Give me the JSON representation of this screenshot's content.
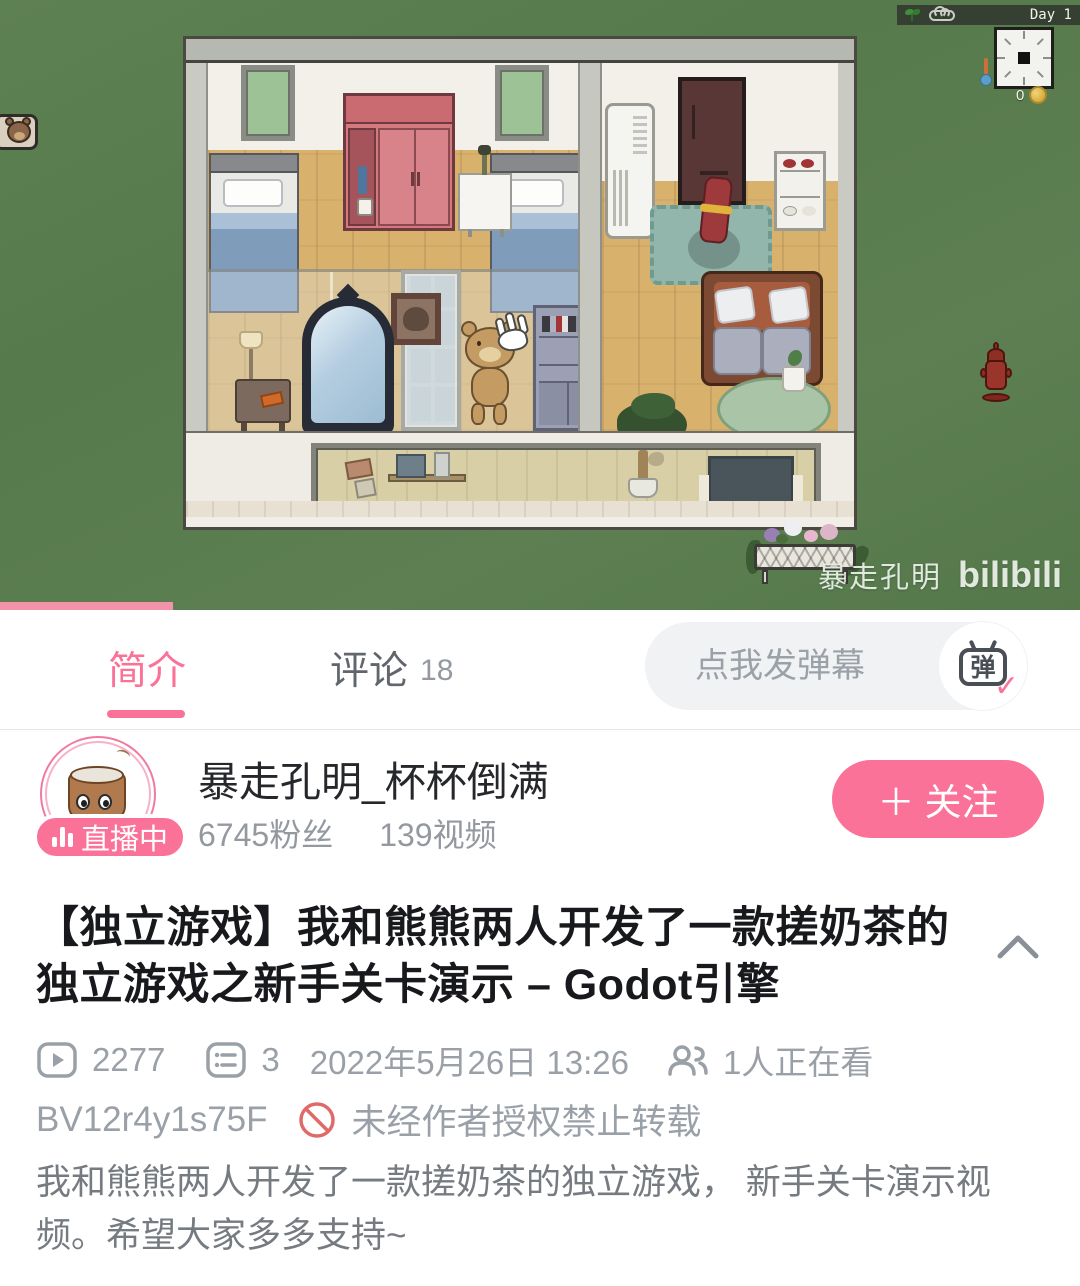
{
  "colors": {
    "brand_pink": "#fb7299",
    "progress_pink": "#f293ab",
    "text_dark": "#18191c",
    "text_gray": "#9aa0a7",
    "desc_gray": "#767b81",
    "grass_green": "#5a7d50",
    "prohibit_red": "#e06a6a"
  },
  "video": {
    "hud": {
      "day_label": "Day 1",
      "coin_count": "0",
      "sprout_icon": "sprout-icon",
      "cloud_icon": "cloud-icon",
      "clock_icon": "analog-clock",
      "thermometer_icon": "thermometer-icon",
      "coin_icon": "gold-coin-icon"
    },
    "watermark": {
      "uploader": "暴走孔明",
      "logo": "bilibili"
    },
    "progress_percent": 16
  },
  "tabs": {
    "intro": "简介",
    "comments": "评论",
    "comments_count": "18"
  },
  "danmaku": {
    "placeholder": "点我发弹幕",
    "toggle_char": "弹",
    "toggle_check": "✓"
  },
  "uploader": {
    "name": "暴走孔明_杯杯倒满",
    "fans": "6745粉丝",
    "videos": "139视频",
    "live_badge": "直播中",
    "follow_plus": "＋",
    "follow_label": "关注"
  },
  "video_info": {
    "title": "【独立游戏】我和熊熊两人开发了一款搓奶茶的独立游戏之新手关卡演示 – Godot引擎",
    "play_count": "2277",
    "comment_count": "3",
    "publish_date": "2022年5月26日 13:26",
    "watching": "1人正在看",
    "bvid": "BV12r4y1s75F",
    "copyright_notice": "未经作者授权禁止转载",
    "description": "我和熊熊两人开发了一款搓奶茶的独立游戏， 新手关卡演示视频。希望大家多多支持~"
  }
}
